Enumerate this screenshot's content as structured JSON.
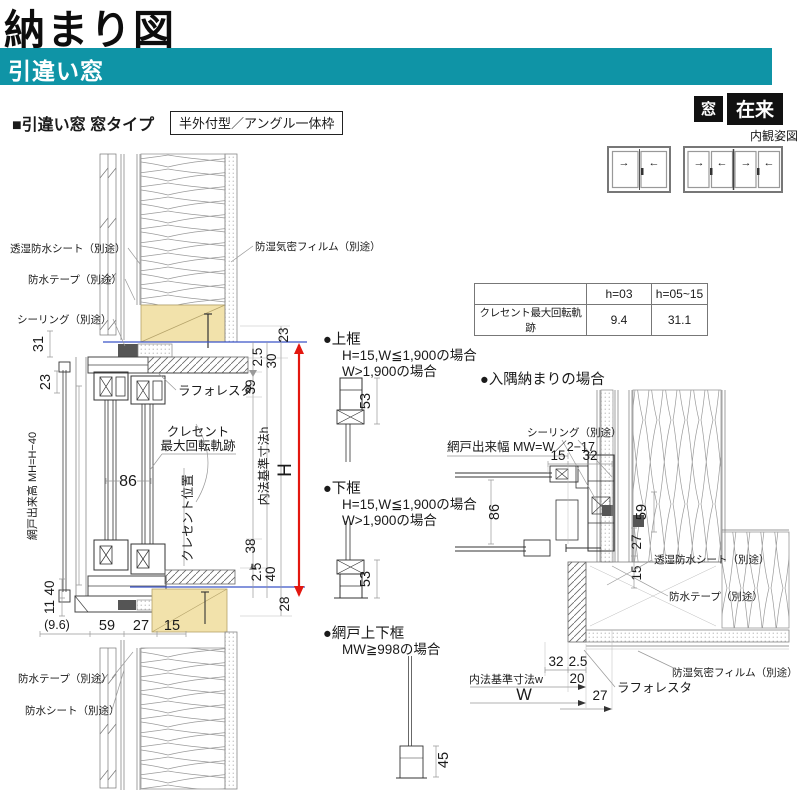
{
  "header": {
    "title": "納まり図",
    "bar_title": "引違い窓",
    "section_heading": "■引違い窓 窓タイプ",
    "type_box": "半外付型／アングル一体枠",
    "badge_window": "窓",
    "badge_construction": "在来",
    "elevation_caption": "内観姿図"
  },
  "colors": {
    "teal": "#0f94a6",
    "red": "#e3170f",
    "blue": "#3a53c8",
    "wood": "#f2e2ab"
  },
  "table": {
    "headers": [
      "",
      "h=03",
      "h=05~15"
    ],
    "row": [
      "クレセント最大回転軌跡",
      "9.4",
      "31.1"
    ]
  },
  "sections": {
    "top_rail": {
      "title": "●上框",
      "cond1": "H=15,W≦1,900の場合",
      "cond2": "W>1,900の場合"
    },
    "bottom_rail": {
      "title": "●下框",
      "cond1": "H=15,W≦1,900の場合",
      "cond2": "W>1,900の場合"
    },
    "screen_rail": {
      "title": "●網戸上下框",
      "cond1": "MW≧998の場合"
    },
    "corner": {
      "title": "●入隅納まりの場合"
    }
  },
  "labels": {
    "moisture_sheet": "透湿防水シート（別途）",
    "waterproof_tape": "防水テープ（別途）",
    "sealing": "シーリング（別途）",
    "vapor_film": "防湿気密フィルム（別途）",
    "laforesta": "ラフォレスタ",
    "crescent1": "クレセント",
    "crescent2": "最大回転軌跡",
    "crescent_pos": "クレセント位置",
    "screen_height": "網戸出来高 MH=H−40",
    "inner_h": "内法基準寸法h",
    "H": "H",
    "waterproof_sheet": "防水シート（別途）",
    "screen_width": "網戸出来幅 MW=W／2−17",
    "inner_w": "内法基準寸法w",
    "W": "W"
  },
  "dims": {
    "31": "31",
    "23": "23",
    "86": "86",
    "40": "40",
    "11": "11",
    "96": "(9.6)",
    "59": "59",
    "27": "27",
    "15": "15",
    "25": "2.5",
    "30": "30",
    "39": "39",
    "38": "38",
    "28": "28",
    "53": "53",
    "45": "45",
    "32": "32",
    "20": "20"
  },
  "arrows": {
    "right": "→",
    "left": "←"
  }
}
